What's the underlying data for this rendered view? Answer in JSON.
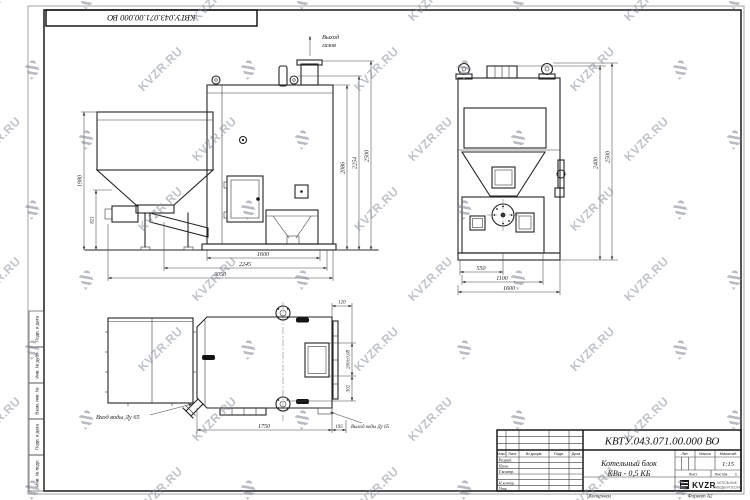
{
  "watermark": {
    "text": "KVZR.RU"
  },
  "corner_stamp": "КВТУ.043.071.00.000 ВО",
  "margin_labels": [
    "Подп. и дата",
    "Инв. № дубл.",
    "Взам. инв. №",
    "Подп. и дата",
    "Инв. № подл."
  ],
  "front_view": {
    "gas_out": [
      "Выход",
      "газов"
    ],
    "dims": {
      "left_outer": "1980",
      "left_inner": "821",
      "right_inner": "2086",
      "right_mid": "2254",
      "right_outer": "2500",
      "bottom_inner": "1600",
      "bottom_mid": "2245",
      "bottom_outer": "3050"
    }
  },
  "side_view": {
    "dims": {
      "right_inner": "2400",
      "right_outer": "2500",
      "bottom_inner": "550",
      "bottom_mid": "1100",
      "bottom_outer": "1600"
    }
  },
  "plan_view": {
    "water_in": "Вход воды Ду 65",
    "water_out": "Выход воды Ду 65",
    "dims": {
      "top": "120",
      "right_upper": "200±0,08",
      "right_lower": "302",
      "bottom_main": "1750",
      "bottom_right": "195"
    }
  },
  "title_block": {
    "doc_number": "КВТУ.043.071.00.000 ВО",
    "product_name_line1": "Котельный блок",
    "product_name_line2": "КВа - 0,5 КБ",
    "columns": {
      "izm": "Изм.",
      "list": "Лист",
      "docum": "№ докум.",
      "podp": "Подп.",
      "date": "Дата"
    },
    "staff_rows": [
      "Разраб.",
      "Пров.",
      "Т.контр.",
      "",
      "Н.контр.",
      "Утв."
    ],
    "lit_label": "Лит.",
    "mass_label": "Масса",
    "scale_label": "Масштаб",
    "scale_value": "1:15",
    "sheet_label": "Лист",
    "sheets_label": "Листов",
    "sheets_count": "1",
    "brand": {
      "logo": "KVZR",
      "line1": "КОТЕЛЬНЫЕ",
      "line2": "ЗАВОДЫ РОССИИ"
    },
    "copied_label": "Копировал",
    "format_label": "Формат А2"
  }
}
